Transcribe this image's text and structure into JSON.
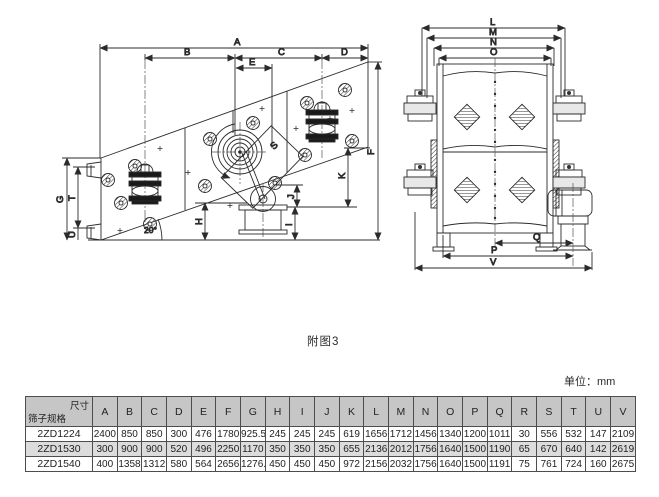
{
  "figure": {
    "caption": "附图3",
    "unit_note": "单位：mm"
  },
  "side_view": {
    "title": "vibrating-screen-side-view",
    "angle_label": "20°",
    "dim_labels": {
      "A": "A",
      "B": "B",
      "C": "C",
      "D": "D",
      "E": "E",
      "F": "F",
      "G": "G",
      "H": "H",
      "I": "I",
      "J": "J",
      "K": "K",
      "S": "S",
      "T": "T",
      "U": "U"
    }
  },
  "front_view": {
    "title": "vibrating-screen-front-view",
    "dim_labels": {
      "L": "L",
      "M": "M",
      "N": "N",
      "O": "O",
      "P": "P",
      "Q": "Q",
      "V": "V"
    }
  },
  "table": {
    "corner": {
      "top_right": "尺寸",
      "bottom_left": "筛子规格"
    },
    "columns": [
      "A",
      "B",
      "C",
      "D",
      "E",
      "F",
      "G",
      "H",
      "I",
      "J",
      "K",
      "L",
      "M",
      "N",
      "O",
      "P",
      "Q",
      "R",
      "S",
      "T",
      "U",
      "V"
    ],
    "rows": [
      {
        "model": "2ZD1224",
        "values": [
          "2400",
          "850",
          "850",
          "300",
          "476",
          "1780",
          "925.5",
          "245",
          "245",
          "245",
          "619",
          "1656",
          "1712",
          "1456",
          "1340",
          "1200",
          "1011",
          "30",
          "556",
          "532",
          "147",
          "2109"
        ]
      },
      {
        "model": "2ZD1530",
        "values": [
          "300",
          "900",
          "900",
          "520",
          "496",
          "2250",
          "1170",
          "350",
          "350",
          "350",
          "655",
          "2136",
          "2012",
          "1756",
          "1640",
          "1500",
          "1190",
          "65",
          "670",
          "640",
          "142",
          "2619"
        ]
      },
      {
        "model": "2ZD1540",
        "values": [
          "400",
          "1358",
          "1312",
          "580",
          "564",
          "2656",
          "1276.5",
          "450",
          "450",
          "450",
          "972",
          "2156",
          "2032",
          "1756",
          "1640",
          "1500",
          "1191",
          "75",
          "761",
          "724",
          "160",
          "2675"
        ]
      }
    ]
  },
  "colors": {
    "line": "#2b2b2b",
    "table_header_bg": "#c6c6c6",
    "table_stripe_bg": "#dcdcdc",
    "background": "#ffffff"
  }
}
